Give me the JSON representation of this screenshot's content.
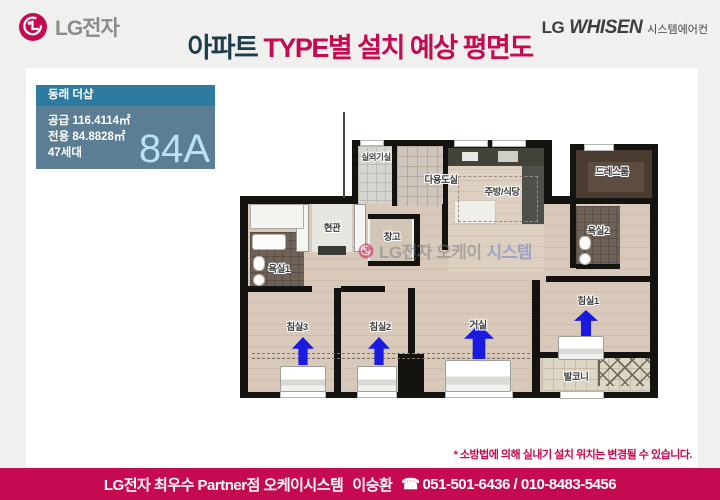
{
  "header": {
    "logo_text": "LG전자",
    "title_part1": "아파트",
    "title_part2": " TYPE별 설치 예상 평면도",
    "brand_lg": "LG",
    "brand_whisen": "WHISEN",
    "brand_sub": "시스템에어컨"
  },
  "info_box": {
    "complex_name": "동래 더샵",
    "supply": "공급 116.4114㎡",
    "exclusive": "전용 84.8828㎡",
    "households": "47세대",
    "type_label": "84A"
  },
  "floorplan": {
    "rooms": [
      {
        "label": "실외기실"
      },
      {
        "label": "다용도실"
      },
      {
        "label": "주방/식당"
      },
      {
        "label": "드레스룸"
      },
      {
        "label": "욕실2"
      },
      {
        "label": "현관"
      },
      {
        "label": "창고"
      },
      {
        "label": "욕실1"
      },
      {
        "label": "침실3"
      },
      {
        "label": "침실2"
      },
      {
        "label": "거실"
      },
      {
        "label": "침실1"
      },
      {
        "label": "발코니"
      }
    ],
    "watermark": {
      "gray": "LG전자 오케이",
      "blue": "시스템"
    },
    "ac_unit_count": "4"
  },
  "disclaimer": "* 소방법에 의해 실내기 설치 위치는 변경될 수 있습니다.",
  "footer": {
    "dealer": "LG전자 최우수 Partner점 오케이시스템",
    "name": "이승환",
    "phone_icon": "☎",
    "phone": "051-501-6436 / 010-8483-5456"
  },
  "colors": {
    "accent_pink": "#c50a52",
    "title_navy": "#1d3c4c",
    "info_header_teal": "#2d7ba0",
    "info_body_slate": "#5c7e94",
    "type_label_blue": "#b9e3f6",
    "arrow_blue": "#1a1ae0",
    "page_bg": "#f0f0ee"
  }
}
